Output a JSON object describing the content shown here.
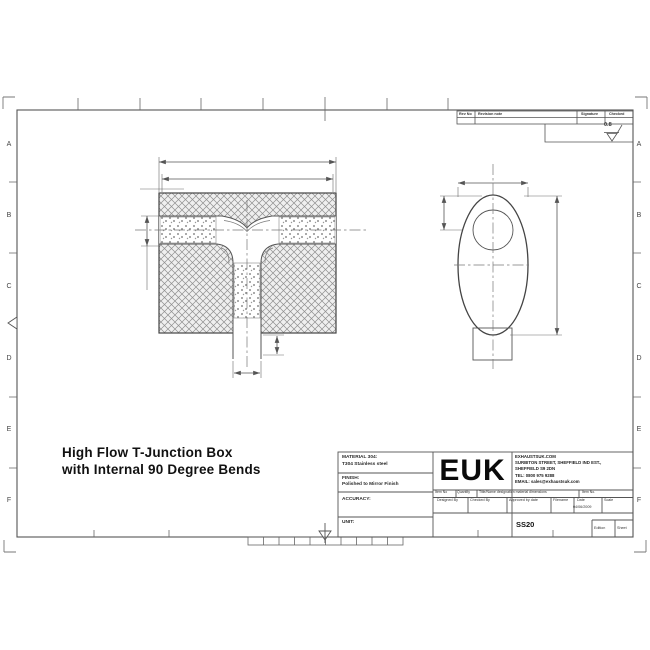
{
  "drawing_title": {
    "line1": "High Flow T-Junction Box",
    "line2": "with Internal 90 Degree Bends"
  },
  "sheet": {
    "row_labels": [
      "A",
      "B",
      "C",
      "D",
      "E",
      "F"
    ],
    "surface_finish_value": "0.8"
  },
  "revision_table": {
    "rev_no": "Rev No",
    "revision_note": "Revision note",
    "signature": "Signature",
    "checked": "Checked"
  },
  "title_block": {
    "material_label": "MATERIAL 304:",
    "material_value": "T304 Stainless steel",
    "finish_label": "FINISH:",
    "finish_value": "Polished to Mirror Finish",
    "accuracy_label": "ACCURACY:",
    "unit_label": "UNIT:",
    "logo": "EUK",
    "company": [
      "EXHAUSTSUK.COM",
      "SURBITON STREET, SHEFFIELD IND EST.,",
      "SHEFFIELD S9 2DN",
      "TEL: 0800 975 9288",
      "EMAIL: sales@exhaustsuk.com"
    ],
    "item_row": [
      "Item No",
      "Quantity",
      "Title/Name designation material dimensions",
      "Item No."
    ],
    "sign_row": [
      "Designed By",
      "Checked By",
      "Approved by date",
      "Filename",
      "Date",
      "Scale"
    ],
    "date_value": "04/06/2009",
    "drawing_number": "SS20",
    "edition_label": "Edition",
    "sheet_label": "Sheet"
  },
  "colors": {
    "line": "#555555",
    "hatch": "#8f8f8f",
    "text": "#1a1a1a",
    "background": "#ffffff"
  }
}
